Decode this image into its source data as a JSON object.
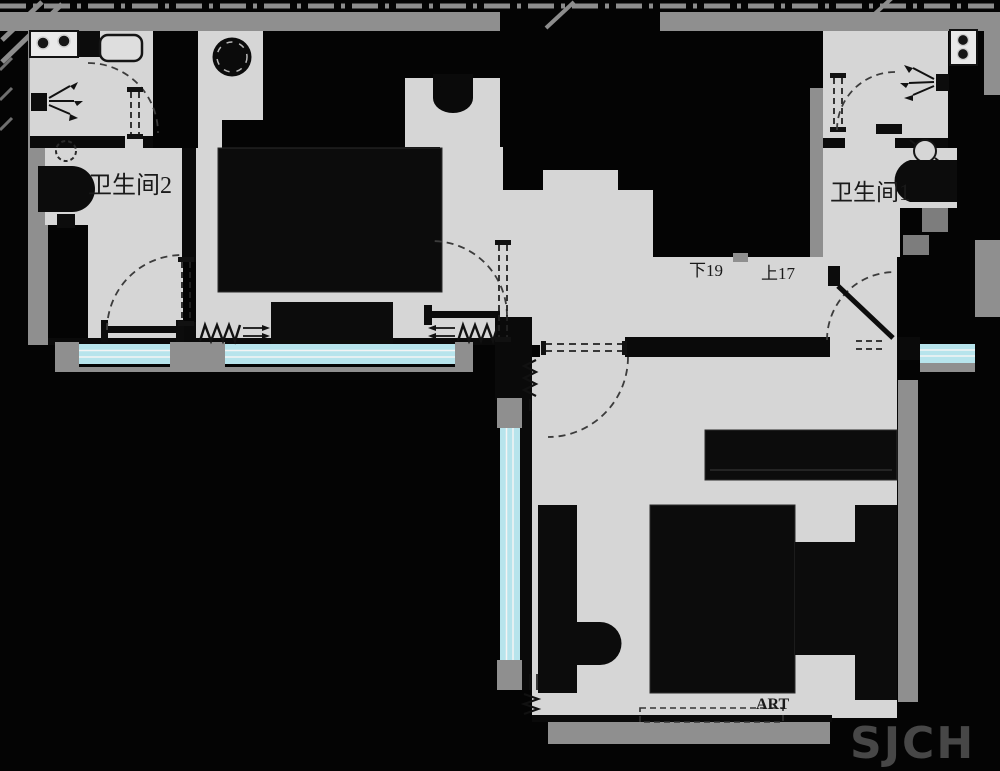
{
  "document": {
    "type": "apartment-floor-plan",
    "labels": {
      "bathroom2": "卫生间2",
      "bathroom1": "卫生间1",
      "stairs_down": "下19",
      "stairs_up": "上17",
      "art": "ART"
    },
    "watermark": "SJCH",
    "colors": {
      "background": "#040404",
      "floor": "#d6d6d6",
      "wall": "#8f8f8f",
      "window": "#b7e4ec",
      "furniture": "#0c0c0c",
      "label_text": "#1a1a1a",
      "watermark_text": "#474747"
    }
  }
}
